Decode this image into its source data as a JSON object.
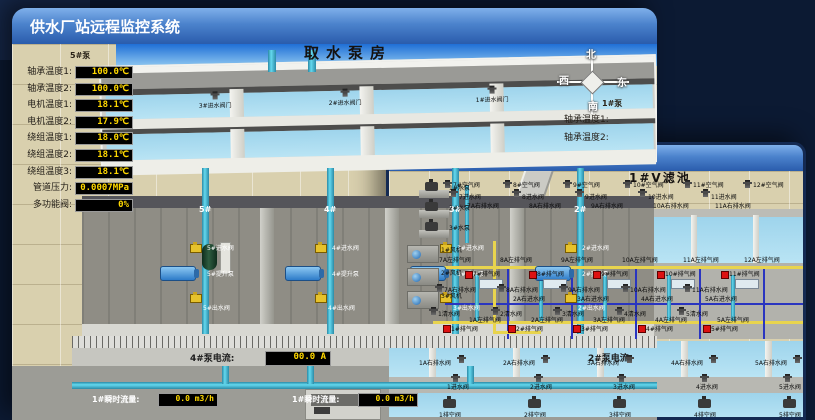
{
  "colors": {
    "background": "#0c1a33",
    "titlebar_top": "#7fb0ea",
    "titlebar_bottom": "#2a5cac",
    "ground": "#d9d0ae",
    "water": "#a9dcf0",
    "led_text": "#ffd800",
    "pipe_cyan": "#63d8ee",
    "pipe_yellow": "#e8d44e",
    "pipe_blue": "#2a35c0",
    "valve_red": "#dd1111",
    "valve_yellow": "#e6c22c"
  },
  "back_window": {
    "title": "供水厂站远程监控系统",
    "scene_title": "取水泵房",
    "pump_panel": {
      "header": "5#泵",
      "rows": [
        {
          "label": "轴承温度1:",
          "value": "100.0℃"
        },
        {
          "label": "轴承温度2:",
          "value": "100.0℃"
        },
        {
          "label": "电机温度1:",
          "value": "18.1℃"
        },
        {
          "label": "电机温度2:",
          "value": "17.9℃"
        },
        {
          "label": "绕组温度1:",
          "value": "18.0℃"
        },
        {
          "label": "绕组温度2:",
          "value": "18.1℃"
        },
        {
          "label": "绕组温度3:",
          "value": "18.1℃"
        },
        {
          "label": "管道压力:",
          "value": "0.0007MPa"
        },
        {
          "label": "多功能阀:",
          "value": "0%"
        }
      ]
    },
    "side_panel": {
      "header": "1#泵",
      "labels": [
        "轴承温度1:",
        "轴承温度2:"
      ]
    },
    "intake_valves": [
      "3#进水阀门",
      "2#进水阀门",
      "1#进水阀门"
    ],
    "pump_bays": [
      {
        "number": "5#",
        "inlet": "5#进水阀",
        "pump": "5#提升泵",
        "outlet": "5#出水阀"
      },
      {
        "number": "4#",
        "inlet": "4#进水阀",
        "pump": "4#提升泵",
        "outlet": "4#出水阀"
      },
      {
        "number": "3#",
        "inlet": "3#进水阀",
        "pump": "3#提升泵",
        "outlet": "3#出水阀"
      },
      {
        "number": "2#",
        "inlet": "2#进水阀",
        "pump": "2#提升泵",
        "outlet": "2#出水阀"
      }
    ],
    "current_displays": [
      {
        "label": "4#泵电流:",
        "value": "00.0 A"
      },
      {
        "label": "2#泵电流:",
        "value": ""
      }
    ],
    "flow_displays": [
      {
        "label": "1#瞬时流量:",
        "value": "0.0 m3/h"
      },
      {
        "label": "1#瞬时流量:",
        "value": "0.0 m3/h"
      }
    ],
    "compass": {
      "north": "北",
      "west": "西",
      "south": "南",
      "east": "东"
    }
  },
  "front_window": {
    "title": "供水厂站远程监控系统",
    "scene_title": "1#V滤池",
    "top_air_valves": [
      "7#空气阀",
      "8#空气阀",
      "9#空气阀",
      "10#空气阀",
      "11#空气阀",
      "12#空气阀"
    ],
    "top_inlet_valves": [
      "7进水阀",
      "8进水阀",
      "9进水阀",
      "10进水阀",
      "11进水阀"
    ],
    "top_drain_valves": [
      "7A右排水阀",
      "8A右排水阀",
      "9A右排水阀",
      "10A右排水阀",
      "11A右排水阀"
    ],
    "gallery": {
      "left_exhaust": [
        "7A左排气阀",
        "8A左排气阀",
        "9A左排气阀",
        "10A左排气阀",
        "11A左排气阀",
        "12A左排气阀"
      ],
      "red_air_valves": [
        "7#排气阀",
        "8#排气阀",
        "9#排气阀",
        "10#排气阀",
        "11#排气阀"
      ],
      "right_drain": [
        "7A右排水阀",
        "8A右排水阀",
        "9A右排水阀",
        "10A右排水阀",
        "11A右排水阀"
      ],
      "cross_inlet": [
        "2A右进水阀",
        "3A右进水阀",
        "4A右进水阀",
        "5A右进水阀"
      ],
      "clean_water": [
        "1清水阀",
        "2清水阀",
        "3清水阀",
        "4清水阀",
        "5清水阀"
      ],
      "left_exhaust_lower": [
        "1A左排气阀",
        "2A左排气阀",
        "3A左排气阀",
        "4A左排气阀",
        "5A左排气阀"
      ],
      "red_air_valves_lower": [
        "1#排气阀",
        "2#排气阀",
        "3#排气阀",
        "4#排气阀",
        "5#排气阀"
      ]
    },
    "bottom_drain_valves": [
      "1A右排水阀",
      "2A右排水阀",
      "3A右排水阀",
      "4A右排水阀",
      "5A右排水阀"
    ],
    "bottom_inlet_valves": [
      "1进水阀",
      "2进水阀",
      "3进水阀",
      "4进水阀",
      "5进水阀"
    ],
    "bottom_empty_valves": [
      "1排空阀",
      "2排空阀",
      "3排空阀",
      "4排空阀",
      "5排空阀"
    ],
    "left_pumps": [
      "1#水泵",
      "2#水泵",
      "3#水泵"
    ],
    "left_fans": [
      "1#风机",
      "2#风机",
      "3#风机"
    ]
  }
}
